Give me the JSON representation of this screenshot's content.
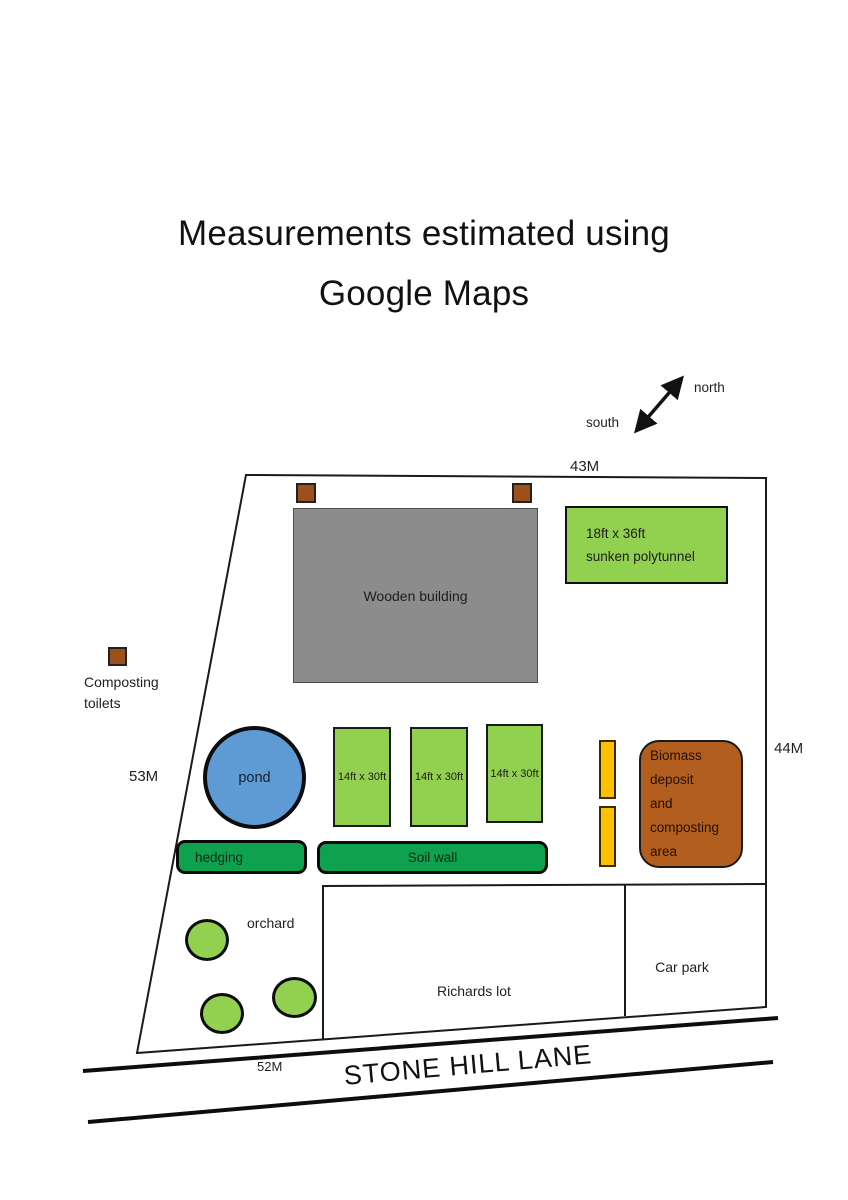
{
  "title": {
    "line1": "Measurements estimated using",
    "line2": "Google Maps"
  },
  "compass": {
    "north": "north",
    "south": "south"
  },
  "measurements": {
    "top": "43M",
    "right": "44M",
    "left": "53M",
    "bottom": "52M"
  },
  "features": {
    "wooden_building": "Wooden building",
    "polytunnel": {
      "line1": "18ft x 36ft",
      "line2": "sunken polytunnel"
    },
    "composting_toilets": {
      "line1": "Composting",
      "line2": "toilets"
    },
    "pond": "pond",
    "plots": [
      "14ft x 30ft",
      "14ft x 30ft",
      "14ft x 30ft"
    ],
    "hedging": "hedging",
    "soil_wall": "Soil wall",
    "biomass": {
      "line1": "Biomass deposit",
      "line2": "and composting",
      "line3": "area"
    },
    "orchard": "orchard",
    "richards_lot": "Richards lot",
    "car_park": "Car park",
    "road": "STONE HILL LANE"
  },
  "colors": {
    "light_green": "#92D050",
    "dark_green": "#0EA24E",
    "pond_blue": "#5E9AD3",
    "building_gray": "#8C8C8C",
    "brown_square": "#9C511C",
    "biomass_brown": "#B25E1E",
    "yellow": "#FFC000",
    "line_black": "#1A1A1A"
  }
}
